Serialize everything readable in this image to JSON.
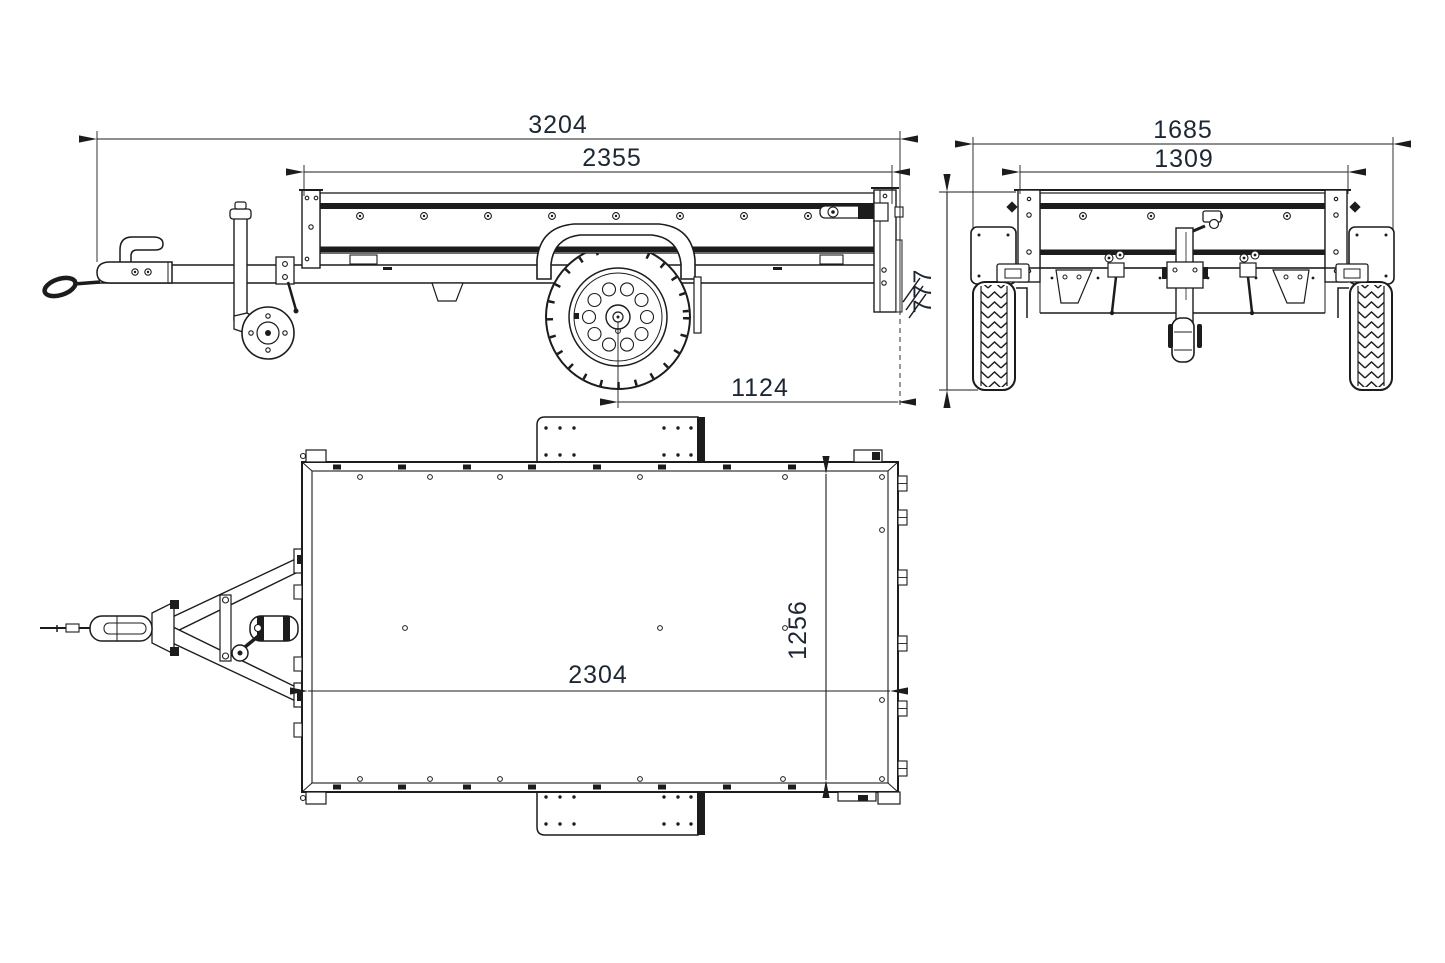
{
  "diagram": {
    "title": "trailer-three-view-dimensional-drawing",
    "views": [
      {
        "id": "side-view",
        "description": "trailer seen from the left side"
      },
      {
        "id": "rear-view",
        "description": "trailer seen from the back"
      },
      {
        "id": "top-view",
        "description": "trailer seen from above"
      }
    ],
    "colors": {
      "line": "#1c1c1c",
      "dimension_text": "#1c2733",
      "background": "#ffffff"
    }
  },
  "dimensions": {
    "side_overall_length": "3204",
    "side_box_length": "2355",
    "side_axle_to_rear": "1124",
    "rear_overall_width": "1685",
    "rear_box_width": "1309",
    "rear_height": "777",
    "top_inner_length": "2304",
    "top_inner_width": "1256"
  }
}
